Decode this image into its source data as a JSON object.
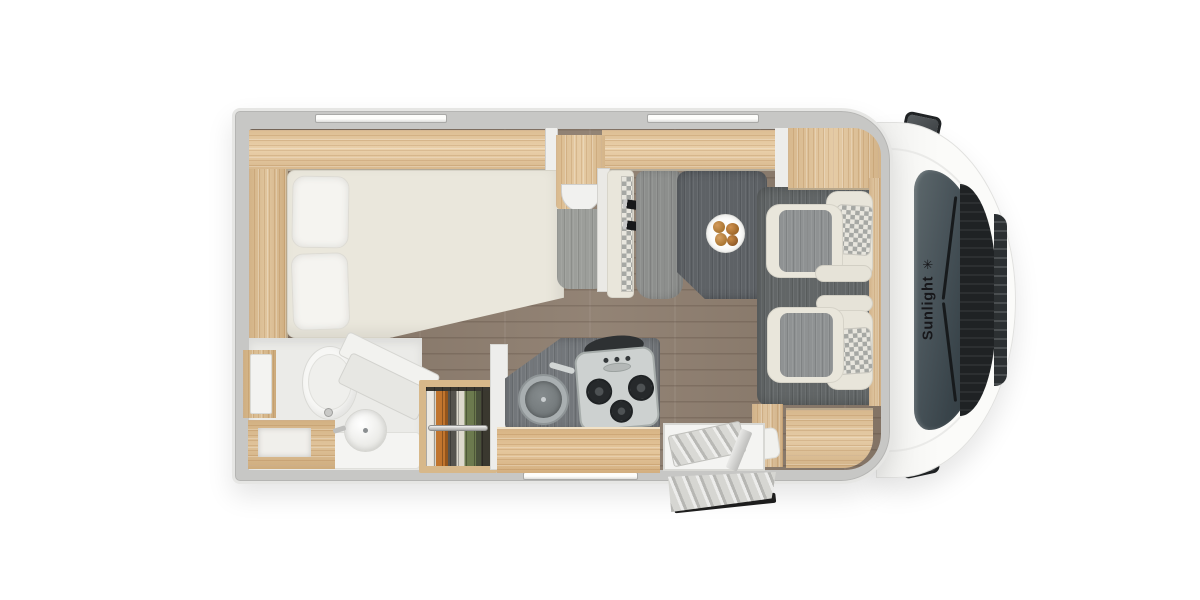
{
  "brand": {
    "name": "Sunlight",
    "logo_symbol": "✳"
  },
  "palette": {
    "background": "#ffffff",
    "wall_grey": "#c7c7c5",
    "wood_light": "#e8cba1",
    "wood_mid": "#ddbf93",
    "floor_wood": "#8d7d6e",
    "table_dark": "#5e6266",
    "upholstery_cream": "#e9e6db",
    "upholstery_grey": "#8f9293",
    "cab_white": "#fafaf8",
    "windshield_dark": "#3c474d",
    "clothes_orange": "#c1752e"
  },
  "floorplan": {
    "vehicle_type": "motorhome",
    "view": "top-down",
    "areas": [
      {
        "name": "bedroom",
        "fixtures": [
          "french-bed",
          "pillows",
          "overhead-cabinets",
          "side-shelf"
        ]
      },
      {
        "name": "bathroom",
        "fixtures": [
          "toilet",
          "washbasin",
          "vanity",
          "shower"
        ]
      },
      {
        "name": "wardrobe",
        "fixtures": [
          "hanging-clothes",
          "clothes-rail"
        ]
      },
      {
        "name": "kitchen",
        "fixtures": [
          "round-sink",
          "three-burner-stove",
          "counter",
          "drawer-unit"
        ]
      },
      {
        "name": "dinette",
        "fixtures": [
          "travel-bench",
          "seatbelt-buckles",
          "table",
          "plate-of-food"
        ]
      },
      {
        "name": "cab",
        "fixtures": [
          "swivel-seat-left",
          "swivel-seat-right",
          "windshield",
          "side-mirrors",
          "brand-logo"
        ]
      },
      {
        "name": "entry",
        "fixtures": [
          "entry-door-open",
          "entry-step"
        ]
      }
    ]
  }
}
